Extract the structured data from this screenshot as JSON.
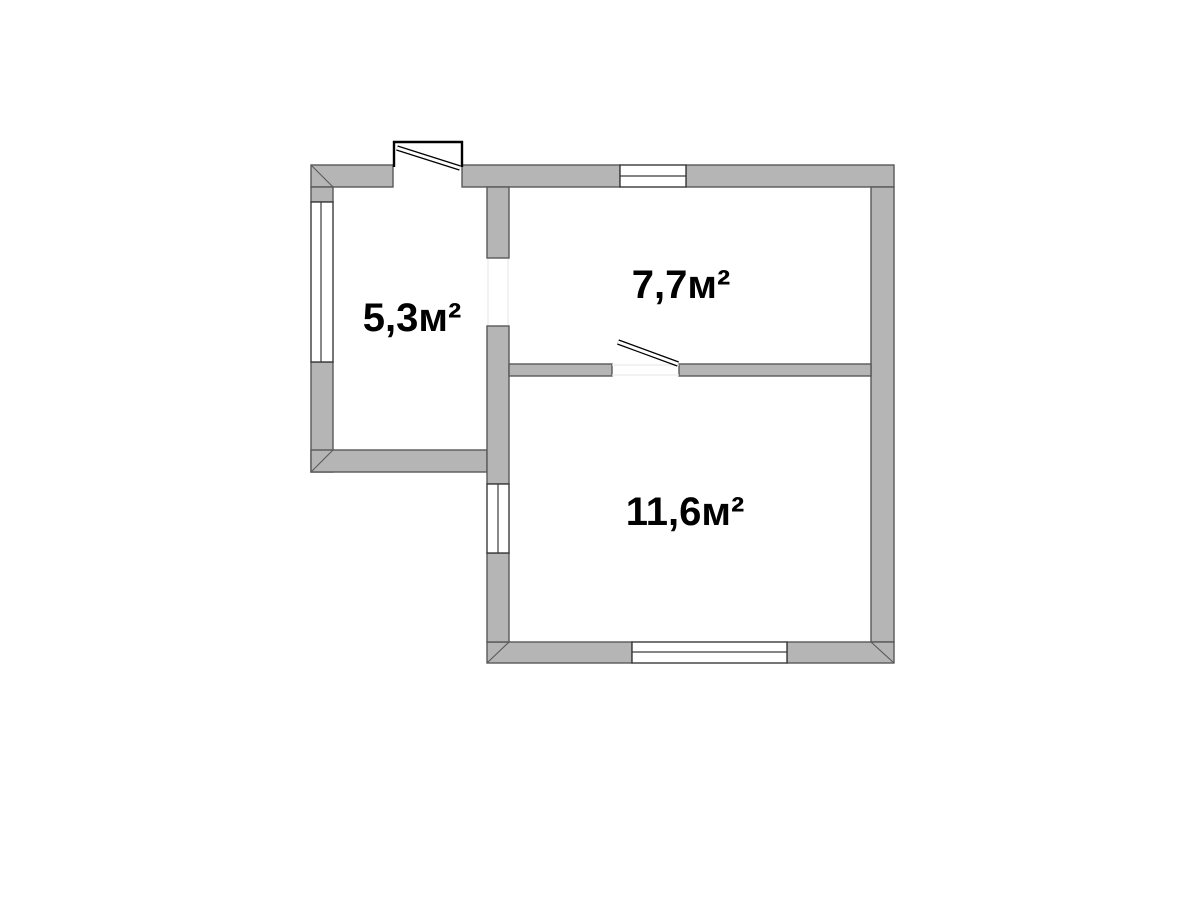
{
  "floor_plan": {
    "rooms": [
      {
        "area_label": "5,3м²"
      },
      {
        "area_label": "7,7м²"
      },
      {
        "area_label": "11,6м²"
      }
    ],
    "colors": {
      "background": "#ffffff",
      "wall_fill": "#b5b5b5",
      "wall_outline": "#595959",
      "window_outline": "#3a3a3a",
      "door_outline": "#000000",
      "label_color": "#000000"
    }
  }
}
